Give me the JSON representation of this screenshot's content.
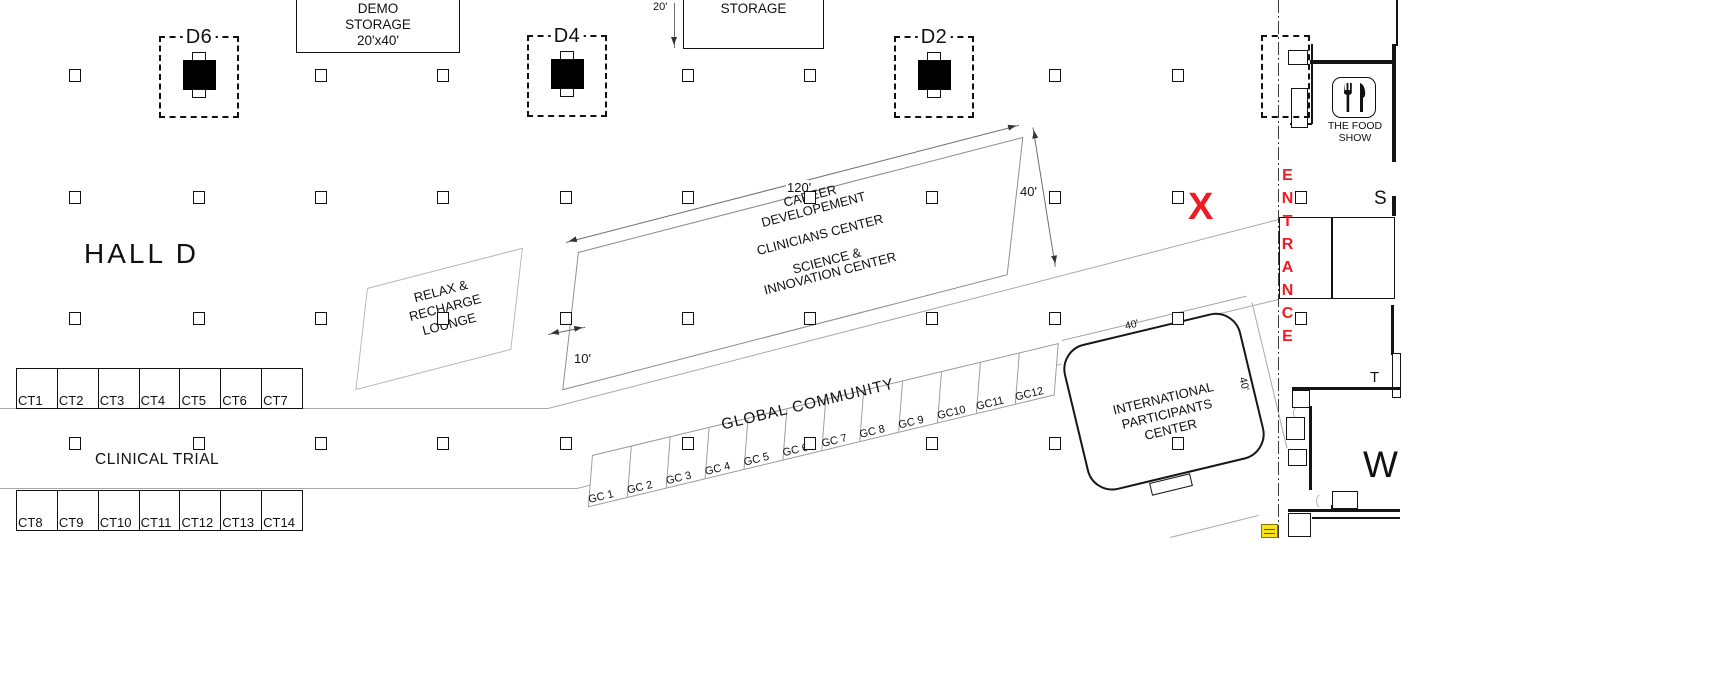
{
  "title": "HALL D",
  "demo_storage": {
    "lines": [
      "DEMO",
      "STORAGE",
      "20'x40'"
    ]
  },
  "storage": {
    "label": "STORAGE"
  },
  "d_markers": {
    "d6": "D6",
    "d4": "D4",
    "d2": "D2"
  },
  "center_block": {
    "lines": [
      "CAREER",
      "DEVELOPEMENT",
      "CLINICIANS CENTER",
      "SCIENCE &",
      "INNOVATION CENTER"
    ]
  },
  "lounge": {
    "lines": [
      "RELAX &",
      "RECHARGE",
      "LOUNGE"
    ]
  },
  "global_community": {
    "title": "GLOBAL COMMUNITY",
    "booths": [
      "GC 1",
      "GC 2",
      "GC 3",
      "GC 4",
      "GC 5",
      "GC 6",
      "GC 7",
      "GC 8",
      "GC 9",
      "GC10",
      "GC11",
      "GC12"
    ]
  },
  "clinical_trial": {
    "title": "CLINICAL TRIAL",
    "row1": [
      "CT1",
      "CT2",
      "CT3",
      "CT4",
      "CT5",
      "CT6",
      "CT7"
    ],
    "row2": [
      "CT8",
      "CT9",
      "CT10",
      "CT11",
      "CT12",
      "CT13",
      "CT14"
    ]
  },
  "ipc": {
    "lines": [
      "INTERNATIONAL",
      "PARTICIPANTS",
      "CENTER"
    ]
  },
  "food_show": {
    "lines": [
      "THE FOOD",
      "SHOW"
    ]
  },
  "entrance": {
    "letters": [
      "E",
      "N",
      "T",
      "R",
      "A",
      "N",
      "C",
      "E"
    ]
  },
  "x_marker": "X",
  "wing_letters": {
    "s": "S",
    "t": "T",
    "w": "W"
  },
  "dimensions": {
    "block_length": "120'",
    "block_depth": "40'",
    "aisle_gap": "10'",
    "storage_depth": "20'",
    "ipc_top": "40'",
    "ipc_right": "40'"
  },
  "colors": {
    "accent_red": "#ed1c24",
    "kiosk_yellow": "#f7e21c"
  }
}
